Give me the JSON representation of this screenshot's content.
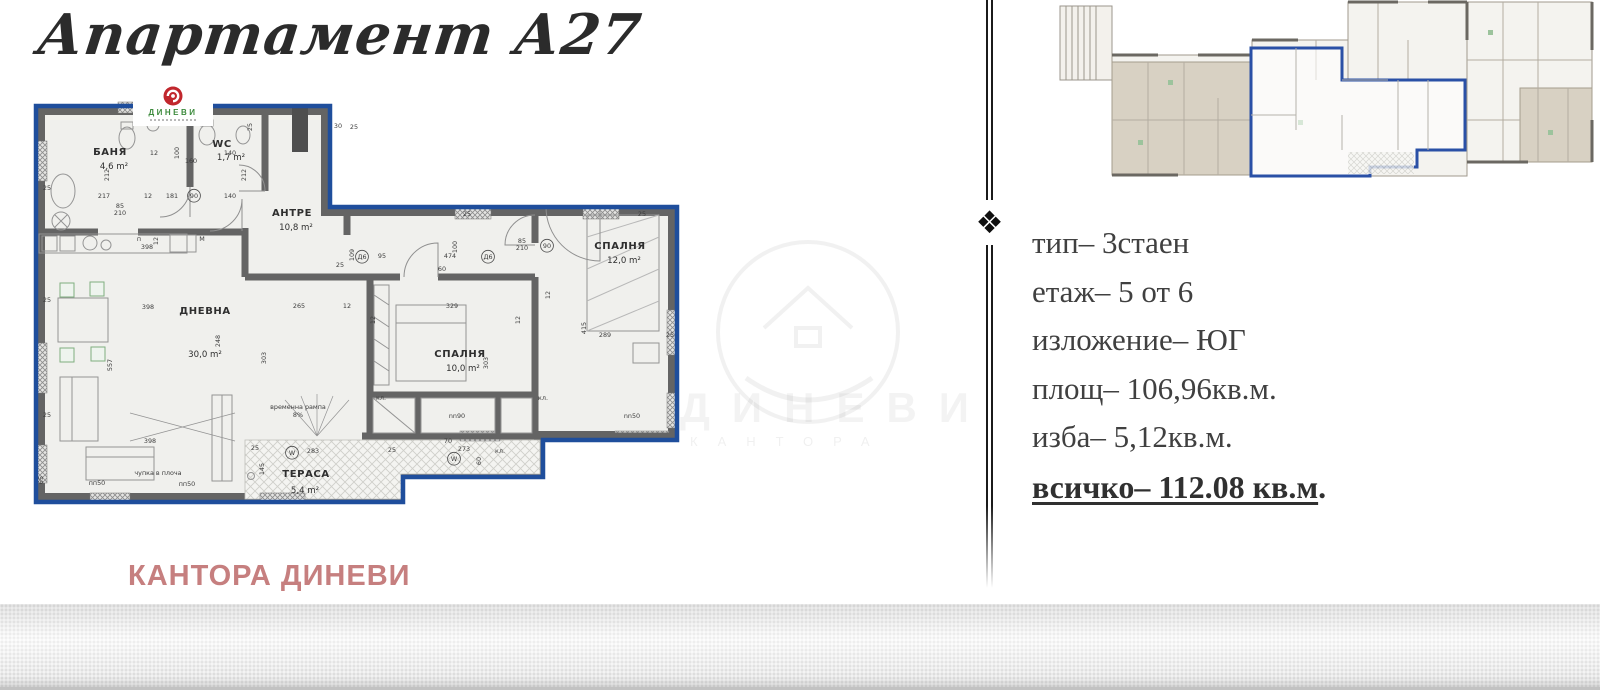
{
  "page": {
    "title": "Апартамент А27"
  },
  "logo": {
    "brand": "ДИНЕВИ"
  },
  "brand_footer": "КАНТОРА ДИНЕВИ",
  "ornament": "❖",
  "info": {
    "lines": [
      "тип– 3стаен",
      "етаж– 5 от 6",
      "изложение– ЮГ",
      "площ– 106,96кв.м.",
      "изба– 5,12кв.м."
    ],
    "total": "всичко– 112.08 кв.м",
    "total_tail": "."
  },
  "watermark": {
    "big": "ДИНЕВИ",
    "small": "КАНТОРА"
  },
  "colors": {
    "outline_blue": "#1f4e9c",
    "wall_gray": "#646464",
    "room_fill": "#f0f0ed",
    "brand_green": "#3c8a3c",
    "brand_red": "#c1272d",
    "footer_rose": "#c67f7f",
    "beige": "#d8d1c3"
  },
  "floorplan": {
    "rooms": [
      {
        "name": "БАНЯ",
        "area": "4,6 m²",
        "nx": 80,
        "ny": 60,
        "ax": 84,
        "ay": 74
      },
      {
        "name": "WC",
        "area": "1,7 m²",
        "nx": 192,
        "ny": 52,
        "ax": 201,
        "ay": 65
      },
      {
        "name": "АНТРЕ",
        "area": "10,8 m²",
        "nx": 262,
        "ny": 121,
        "ax": 266,
        "ay": 135
      },
      {
        "name": "ДНЕВНА",
        "area": "30,0 m²",
        "nx": 175,
        "ny": 219,
        "ax": 175,
        "ay": 262
      },
      {
        "name": "СПАЛНЯ",
        "area": "10,0 m²",
        "nx": 430,
        "ny": 262,
        "ax": 433,
        "ay": 276
      },
      {
        "name": "СПАЛНЯ",
        "area": "12,0 m²",
        "nx": 590,
        "ny": 154,
        "ax": 594,
        "ay": 168
      },
      {
        "name": "ТЕРАСА",
        "area": "5,4 m²",
        "nx": 276,
        "ny": 382,
        "ax": 275,
        "ay": 398
      }
    ],
    "dims": [
      {
        "t": "25",
        "x": 17,
        "y": 95
      },
      {
        "t": "25",
        "x": 17,
        "y": 207
      },
      {
        "t": "25",
        "x": 17,
        "y": 322
      },
      {
        "t": "65",
        "x": 13,
        "y": 385,
        "r": 1
      },
      {
        "t": "217",
        "x": 74,
        "y": 103
      },
      {
        "t": "12",
        "x": 118,
        "y": 103
      },
      {
        "t": "181",
        "x": 142,
        "y": 103
      },
      {
        "t": "90",
        "x": 164,
        "y": 103,
        "c": 1
      },
      {
        "t": "140",
        "x": 200,
        "y": 103
      },
      {
        "t": "85",
        "x": 90,
        "y": 113
      },
      {
        "t": "210",
        "x": 90,
        "y": 120
      },
      {
        "t": "212",
        "x": 79,
        "y": 80,
        "r": 1
      },
      {
        "t": "212",
        "x": 216,
        "y": 80,
        "r": 1
      },
      {
        "t": "100",
        "x": 149,
        "y": 58,
        "r": 1
      },
      {
        "t": "12",
        "x": 124,
        "y": 60
      },
      {
        "t": "160",
        "x": 161,
        "y": 68
      },
      {
        "t": "140",
        "x": 200,
        "y": 60
      },
      {
        "t": "30",
        "x": 308,
        "y": 33
      },
      {
        "t": "25",
        "x": 324,
        "y": 34
      },
      {
        "t": "25",
        "x": 222,
        "y": 32,
        "r": 1
      },
      {
        "t": "25",
        "x": 437,
        "y": 121
      },
      {
        "t": "25",
        "x": 612,
        "y": 121
      },
      {
        "t": "п",
        "x": 109,
        "y": 146
      },
      {
        "t": "М",
        "x": 172,
        "y": 146
      },
      {
        "t": "398",
        "x": 117,
        "y": 154
      },
      {
        "t": "12",
        "x": 128,
        "y": 146,
        "r": 1
      },
      {
        "t": "109",
        "x": 324,
        "y": 160,
        "r": 1
      },
      {
        "t": "25",
        "x": 310,
        "y": 172
      },
      {
        "t": "Д6",
        "x": 332,
        "y": 164,
        "c": 1
      },
      {
        "t": "95",
        "x": 352,
        "y": 163
      },
      {
        "t": "474",
        "x": 420,
        "y": 163
      },
      {
        "t": "Д6",
        "x": 458,
        "y": 164,
        "c": 1
      },
      {
        "t": "100",
        "x": 427,
        "y": 152,
        "r": 1
      },
      {
        "t": "85",
        "x": 492,
        "y": 148
      },
      {
        "t": "210",
        "x": 492,
        "y": 155
      },
      {
        "t": "90",
        "x": 517,
        "y": 153,
        "c": 1
      },
      {
        "t": "265",
        "x": 269,
        "y": 213
      },
      {
        "t": "12",
        "x": 317,
        "y": 213
      },
      {
        "t": "329",
        "x": 422,
        "y": 213
      },
      {
        "t": "398",
        "x": 118,
        "y": 214
      },
      {
        "t": "248",
        "x": 190,
        "y": 246,
        "r": 1
      },
      {
        "t": "303",
        "x": 236,
        "y": 263,
        "r": 1
      },
      {
        "t": "557",
        "x": 82,
        "y": 270,
        "r": 1
      },
      {
        "t": "303",
        "x": 458,
        "y": 268,
        "r": 1
      },
      {
        "t": "60",
        "x": 412,
        "y": 176
      },
      {
        "t": "415",
        "x": 556,
        "y": 233,
        "r": 1
      },
      {
        "t": "289",
        "x": 575,
        "y": 242
      },
      {
        "t": "25",
        "x": 640,
        "y": 242
      },
      {
        "t": "12",
        "x": 520,
        "y": 200,
        "r": 1
      },
      {
        "t": "кл.",
        "x": 351,
        "y": 305
      },
      {
        "t": "кл.",
        "x": 513,
        "y": 305
      },
      {
        "t": "398",
        "x": 120,
        "y": 348
      },
      {
        "t": "чупка в плоча",
        "x": 128,
        "y": 380
      },
      {
        "t": "пп50",
        "x": 67,
        "y": 390
      },
      {
        "t": "пп50",
        "x": 157,
        "y": 391
      },
      {
        "t": "временна рампа",
        "x": 268,
        "y": 314
      },
      {
        "t": "8%",
        "x": 268,
        "y": 322
      },
      {
        "t": "nn90",
        "x": 427,
        "y": 323
      },
      {
        "t": "nn50",
        "x": 602,
        "y": 323
      },
      {
        "t": "W",
        "x": 262,
        "y": 360,
        "c": 1
      },
      {
        "t": "283",
        "x": 283,
        "y": 358
      },
      {
        "t": "25",
        "x": 225,
        "y": 355
      },
      {
        "t": "25",
        "x": 362,
        "y": 357
      },
      {
        "t": "273",
        "x": 434,
        "y": 356
      },
      {
        "t": "W",
        "x": 424,
        "y": 366,
        "c": 1
      },
      {
        "t": "70",
        "x": 418,
        "y": 348
      },
      {
        "t": "кл.",
        "x": 470,
        "y": 358
      },
      {
        "t": "60",
        "x": 451,
        "y": 366,
        "r": 1
      },
      {
        "t": "145",
        "x": 234,
        "y": 374,
        "r": 1
      },
      {
        "t": "12",
        "x": 345,
        "y": 225,
        "r": 1
      },
      {
        "t": "12",
        "x": 490,
        "y": 225,
        "r": 1
      }
    ]
  }
}
